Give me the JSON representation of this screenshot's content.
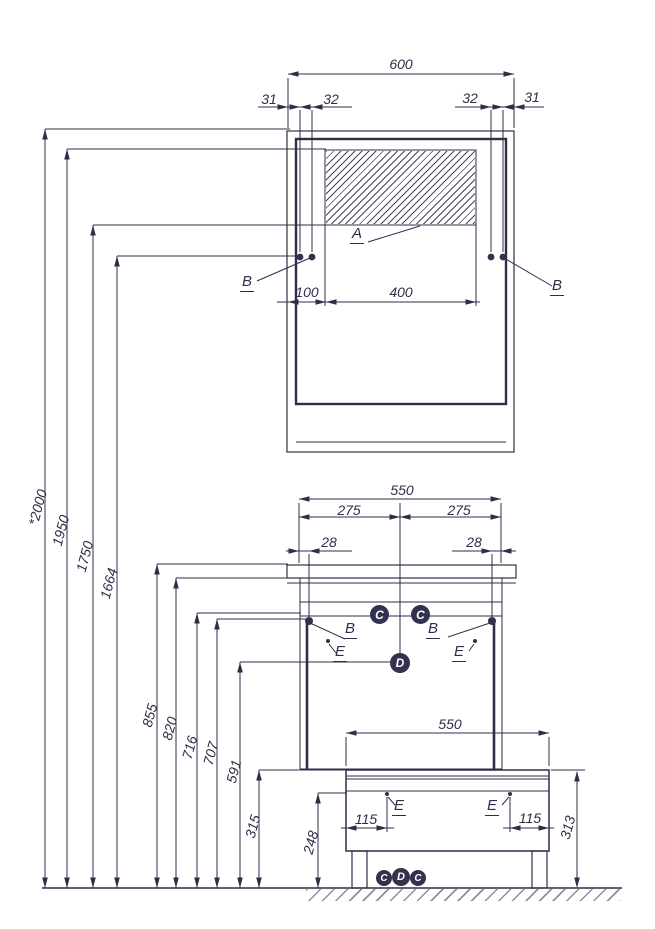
{
  "colors": {
    "line": "#2e2e48",
    "marker_fill": "#32324d",
    "hatch_line": "#45455f",
    "floor_hatch": "#8f8f9b",
    "background": "#ffffff"
  },
  "upper_cabinet": {
    "overall_width": "600",
    "side_offset_left": "31",
    "bolt_spacing_left": "32",
    "bolt_spacing_right": "32",
    "side_offset_right": "31",
    "hatch_offset": "100",
    "hatch_width": "400",
    "hatch_area_label": "A",
    "bolt_label_left": "B",
    "bolt_label_right": "B"
  },
  "height_labels": [
    "*2000",
    "1950",
    "1750",
    "1664",
    "855",
    "820",
    "716",
    "707",
    "591",
    "315",
    "248"
  ],
  "lower_cabinet": {
    "overall_width": "550",
    "half_width_left": "275",
    "half_width_right": "275",
    "bolt_offset_left": "28",
    "bolt_offset_right": "28",
    "bolt_label_left": "B",
    "bolt_label_right": "B",
    "screw_label_left": "E",
    "screw_label_right": "E",
    "marker_left": "C",
    "marker_right": "C",
    "marker_center": "D"
  },
  "bench": {
    "overall_width": "550",
    "height": "313",
    "leg_inset_left": "115",
    "leg_inset_right": "115",
    "screw_label_left": "E",
    "screw_label_right": "E",
    "markers": [
      "C",
      "D",
      "C"
    ]
  }
}
